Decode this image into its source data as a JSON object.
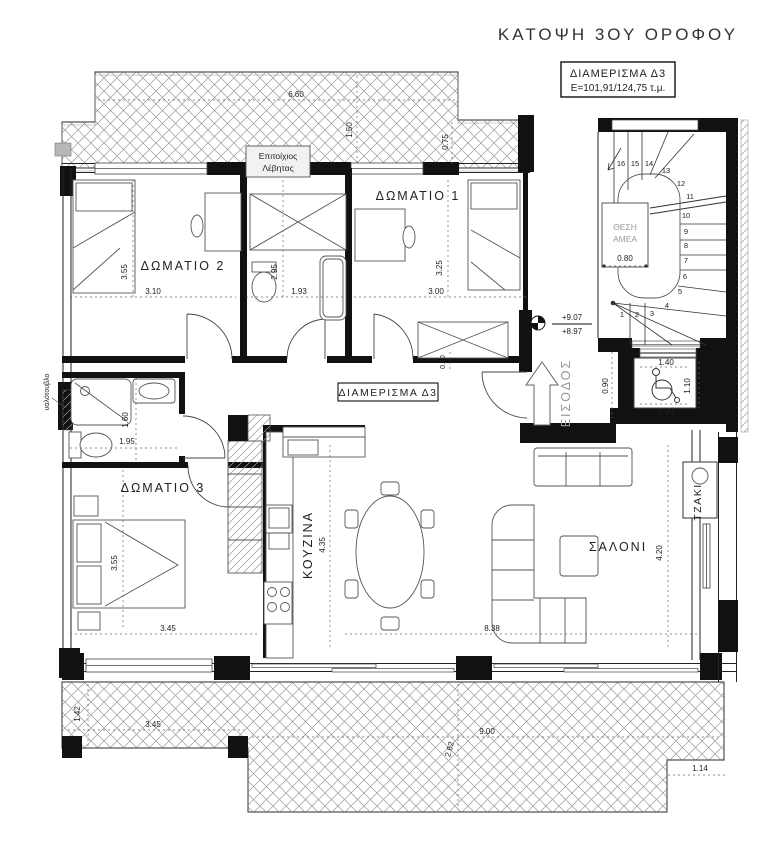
{
  "title": "ΚΑΤΟΨΗ 3ΟΥ ΟΡΟΦΟΥ",
  "info": {
    "line1": "ΔΙΑΜΕΡΙΣΜΑ Δ3",
    "line2": "Ε=101,91/124,75 τ.μ."
  },
  "rooms": {
    "room1": "ΔΩΜΑΤΙΟ 1",
    "room2": "ΔΩΜΑΤΙΟ 2",
    "room3": "ΔΩΜΑΤΙΟ 3",
    "kitchen": "ΚΟΥΖΙΝΑ",
    "living": "ΣΑΛΟΝΙ",
    "fireplace": "ΤΖΑΚΙ",
    "entrance": "ΕΙΣΟΔΟΣ",
    "hall_tag": "ΔΙΑΜΕΡΙΣΜΑ Δ3"
  },
  "annotations": {
    "boiler_line1": "Επιτοίχιος",
    "boiler_line2": "Λέβητας",
    "amea_line1": "ΘΕΣΗ",
    "amea_line2": "ΑΜΕΑ",
    "glass_block": "υαλότουβλο"
  },
  "levels": {
    "upper": "+9.07",
    "lower": "+8.97"
  },
  "dims": {
    "top_len": "6.60",
    "top_d1": "1.50",
    "top_d2": "0.75",
    "r2_w": "3.10",
    "r2_h": "3.55",
    "wc_h": "2.95",
    "wc_w": "1.93",
    "r1_w": "3.00",
    "r1_h": "3.25",
    "amea": "0.80",
    "elev_w": "1.40",
    "elev_d": "1.10",
    "elev_w2": "1.90",
    "elev_d2": "0.90",
    "gap": "0.10",
    "bath_h": "1.60",
    "bath_w": "1.95",
    "r3_h": "3.55",
    "r3_w": "3.45",
    "kit_h": "4.35",
    "liv_w": "8.38",
    "liv_h": "4.20",
    "ter1_h": "1.42",
    "ter1_w": "3.45",
    "ter2_w": "9.00",
    "ter2_h": "2.62",
    "ter_step": "1.14"
  },
  "stairs": {
    "numbers": [
      "1",
      "2",
      "3",
      "4",
      "5",
      "6",
      "7",
      "8",
      "9",
      "10",
      "11",
      "12",
      "13",
      "14",
      "15",
      "16"
    ]
  },
  "colors": {
    "walls": "#111111",
    "hatch": "#999999",
    "background": "#ffffff",
    "muted_text": "#9a9a9a"
  }
}
